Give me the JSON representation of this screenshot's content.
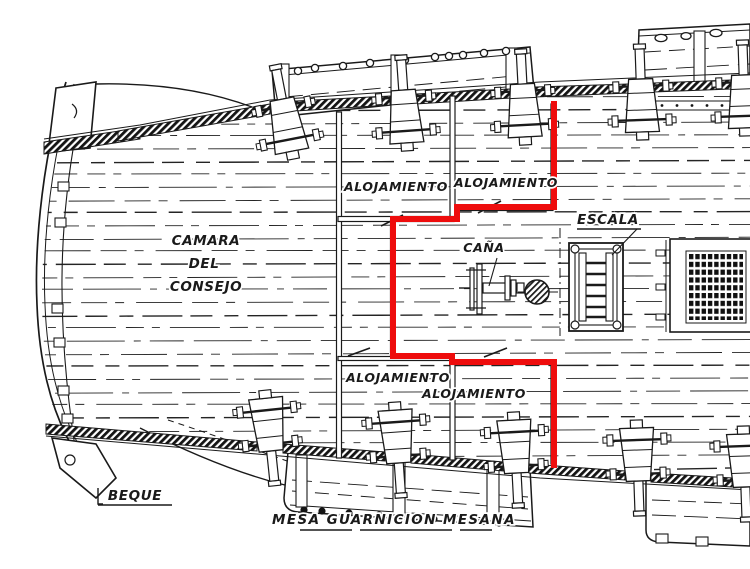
{
  "drawing_title": "ship deck plan (stern section, top view)",
  "labels": {
    "camara": [
      "CAMARA",
      "DEL",
      "CONSEJO"
    ],
    "alojamiento_tl": "ALOJAMIENTO",
    "alojamiento_tr": "ALOJAMIENTO",
    "alojamiento_bl": "ALOJAMIENTO",
    "alojamiento_br": "ALOJAMIENTO",
    "cana": "CAÑA",
    "escala": "ESCALA",
    "beque": "BEQUE",
    "mesa_guarnicion": "MESA GUARNICION MESANA"
  },
  "colors": {
    "highlight": "#ee0d0d",
    "ink": "#1a1a1a",
    "paper": "#ffffff"
  }
}
